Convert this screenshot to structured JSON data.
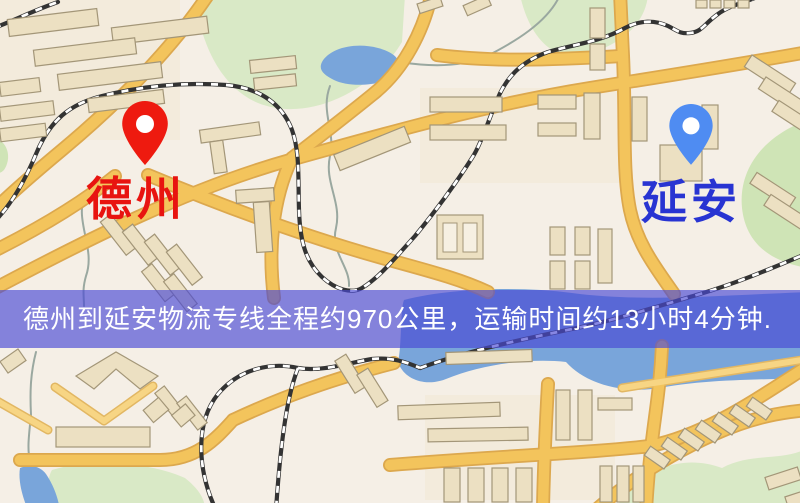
{
  "map": {
    "origin_marker": {
      "label": "德州",
      "pin_icon": "red-map-pin",
      "pin_color": "#ee1a0f",
      "label_color": "#e81410"
    },
    "destination_marker": {
      "label": "延安",
      "pin_icon": "blue-map-pin",
      "pin_color": "#4f8cf2",
      "label_color": "#2834d2"
    },
    "info_banner": {
      "text": "德州到延安物流专线全程约970公里，运输时间约13小时4分钟.",
      "background": "rgba(73,73,212,0.66)",
      "text_color": "#ffffff"
    },
    "route": {
      "origin": "德州",
      "destination": "延安",
      "distance_km": 970,
      "duration_text": "13小时4分钟"
    },
    "palette": {
      "background": "#f5efe6",
      "road_fill": "#f3c45c",
      "road_casing": "#dca84e",
      "building": "#ece0c2",
      "building_outline": "#a39678",
      "park": "#d9e9c6",
      "water": "#79a5da",
      "railway_dark": "#333333",
      "railway_light": "#ffffff"
    }
  }
}
